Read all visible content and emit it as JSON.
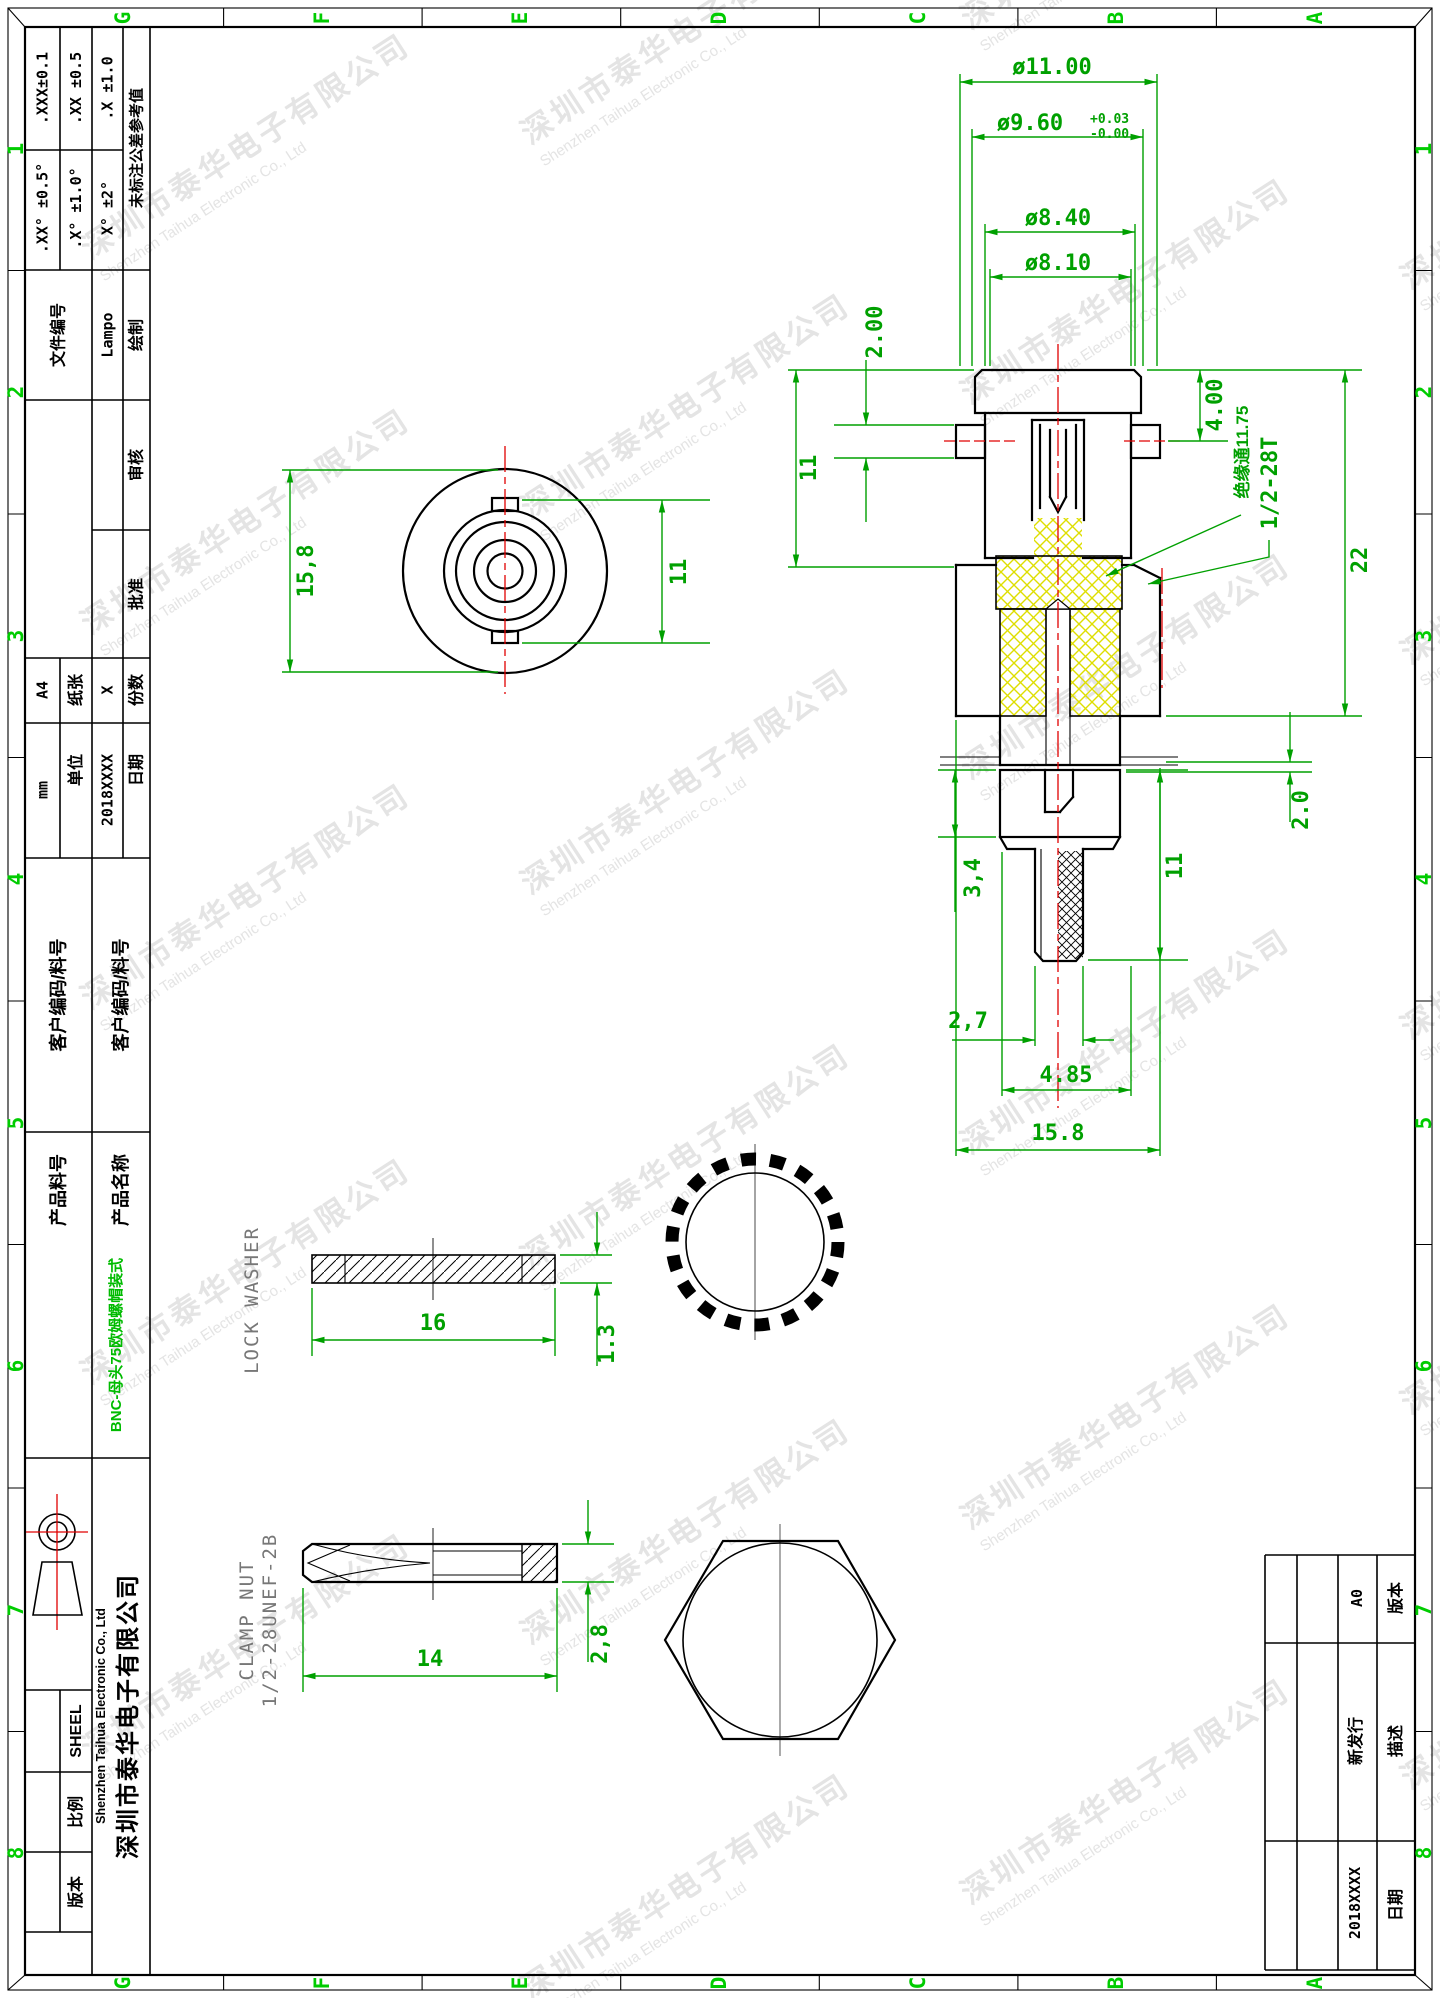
{
  "frame": {
    "cols": [
      "G",
      "F",
      "E",
      "D",
      "C",
      "B",
      "A"
    ],
    "rows": [
      "1",
      "2",
      "3",
      "4",
      "5",
      "6",
      "7",
      "8"
    ]
  },
  "watermark": {
    "cn": "深圳市泰华电子有限公司",
    "en": "Shenzhen Taihua Electronic Co., Ltd"
  },
  "title_block": {
    "tolerance": {
      "header": "未标注公差参考值",
      "linear": [
        ".X ±1.0",
        ".XX ±0.5",
        ".XXX±0.1"
      ],
      "angular": [
        "X° ±2°",
        ".X° ±1.0°",
        ".XX° ±0.5°"
      ]
    },
    "drawn_label": "绘制",
    "drawn_value": "Lampo",
    "file_no_label": "文件编号",
    "check_label": "审核",
    "approve_label": "批准",
    "copies_label": "份数",
    "copies_value": "X",
    "paper_label": "纸张",
    "paper_value": "A4",
    "date_label": "日期",
    "date_value": "2018XXXX",
    "unit_label": "单位",
    "unit_value": "mm",
    "customer_code_label": "客户编码/料号",
    "customer_code_label2": "客户编码/料号",
    "product_name_label": "产品名称",
    "product_name_value": "BNC-母头75欧姆螺帽装式",
    "product_no_label": "产品料号",
    "company_cn": "深圳市泰华电子有限公司",
    "company_en": "Shenzhen Taihua Electronic Co., Ltd",
    "sheet_label": "SHEEL",
    "scale_label": "比例",
    "version_label": "版本"
  },
  "revision_table": {
    "version_label": "版本",
    "version_value": "A0",
    "desc_label": "描述",
    "desc_value": "新发行",
    "date_label": "日期",
    "date_value": "2018XXXX"
  },
  "dims": {
    "dia_outer": "ø11.00",
    "dia_960": "ø9.60",
    "tol_plus": "+0.03",
    "tol_minus": "-0.00",
    "dia_840": "ø8.40",
    "dia_810": "ø8.10",
    "pin": "2.00",
    "shell_len": "11",
    "lug": "4.00",
    "thread": "1/2-28T",
    "insulator": "绝缘通11.75",
    "total": "22",
    "washer_gap": "2.0",
    "rear_len": "11",
    "slot": "3,4",
    "stem": "2,7",
    "boss": "4.85",
    "flange": "15.8",
    "front_od": "15,8",
    "front_lug": "11",
    "washer_od": "16",
    "washer_t": "1.3",
    "washer_label": "LOCK WASHER",
    "nut_w": "14",
    "nut_t": "2,8",
    "nut_label1": "1/2-28UNEF-2B",
    "nut_label2": "CLAMP NUT"
  }
}
